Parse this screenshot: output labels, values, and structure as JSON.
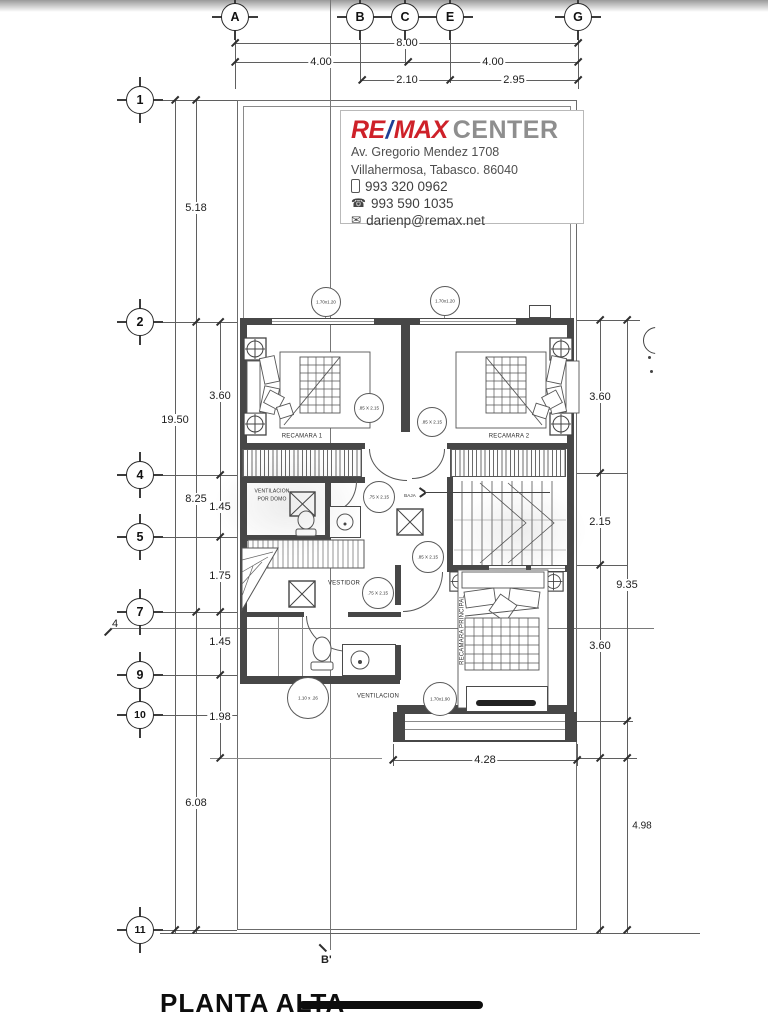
{
  "title": "PLANTA ALTA",
  "branding": {
    "brand_re": "RE",
    "brand_slash": "/",
    "brand_max": "MAX",
    "brand_name": "CENTER",
    "address_line1": "Av. Gregorio Mendez 1708",
    "address_line2": "Villahermosa, Tabasco. 86040",
    "phone_mobile": "993 320 0962",
    "phone_office": "993 590 1035",
    "email": "darienp@remax.net",
    "colors": {
      "remax_red": "#CE2129",
      "remax_blue": "#1F4096",
      "center_gray": "#8E8E8E"
    }
  },
  "axes": {
    "top": [
      "A",
      "B",
      "C",
      "E",
      "G"
    ],
    "left": [
      "1",
      "2",
      "4",
      "5",
      "7",
      "9",
      "10",
      "11"
    ]
  },
  "dim": {
    "top": [
      "8.00",
      "4.00",
      "4.00",
      "2.10",
      "2.95"
    ],
    "left": [
      "19.50",
      "5.18",
      "8.25",
      "6.08",
      "3.60",
      "1.45",
      "1.75",
      "1.45",
      "1.98"
    ],
    "right": [
      "3.60",
      "2.15",
      "3.60",
      "9.35",
      "4.98"
    ],
    "bottom": [
      "4.28"
    ]
  },
  "rooms": {
    "bedroom1": "RECAMARA 1",
    "bedroom2": "RECAMARA 2",
    "dressing": "VESTIDOR",
    "stairs": "BAJA",
    "vent_line1": "VENTILACION",
    "vent_line2": "POR DOMO",
    "vent_shaft": "VENTILACION",
    "master": "RECAMARA PRINCIPAL"
  },
  "tags": [
    "1.70x1.20",
    "1.70x1.20",
    ".85 X 2.15",
    ".85 X 2.15",
    ".75 X 2.15",
    ".85 X 2.15",
    ".75 X 2.15",
    "1.10 x .26",
    "1.70x1.90"
  ],
  "sections": {
    "b_prime": "B'",
    "cut_left": "4"
  }
}
